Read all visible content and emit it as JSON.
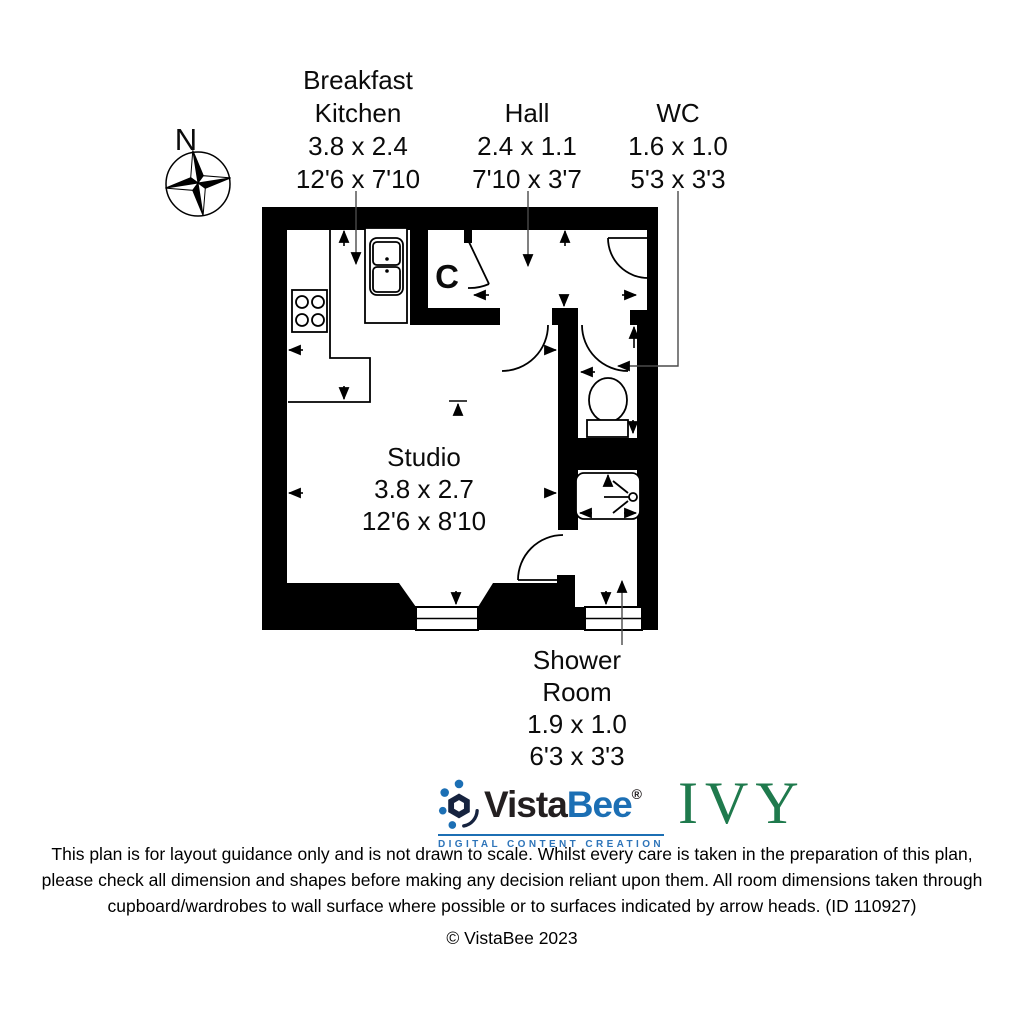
{
  "compass": {
    "label": "N"
  },
  "plan": {
    "closet_label": "C",
    "rooms": [
      {
        "name_lines": [
          "Breakfast",
          "Kitchen"
        ],
        "metric": "3.8 x 2.4",
        "imperial": "12'6 x 7'10"
      },
      {
        "name_lines": [
          "Hall"
        ],
        "metric": "2.4 x 1.1",
        "imperial": "7'10 x 3'7"
      },
      {
        "name_lines": [
          "WC"
        ],
        "metric": "1.6 x 1.0",
        "imperial": "5'3 x 3'3"
      },
      {
        "name_lines": [
          "Studio"
        ],
        "metric": "3.8 x 2.7",
        "imperial": "12'6 x 8'10"
      },
      {
        "name_lines": [
          "Shower",
          "Room"
        ],
        "metric": "1.9 x 1.0",
        "imperial": "6'3 x 3'3"
      }
    ]
  },
  "branding": {
    "name_part1": "Vista",
    "name_part2": "Bee",
    "registered": "®",
    "tagline": "DIGITAL CONTENT CREATION",
    "development_name": "IVY",
    "colors": {
      "logo_blue": "#1c6fb4",
      "ivy_green": "#1f7a4d",
      "ink": "#231f20"
    }
  },
  "footer": {
    "disclaimer_lines": [
      "This plan is for layout guidance only and is not drawn to scale. Whilst every care is taken in the preparation of this plan,",
      "please check all dimension and shapes before making any decision reliant upon them. All room dimensions taken through",
      "cupboard/wardrobes to wall surface where possible or to surfaces indicated by arrow heads. (ID 110927)"
    ],
    "copyright": "© VistaBee 2023"
  }
}
